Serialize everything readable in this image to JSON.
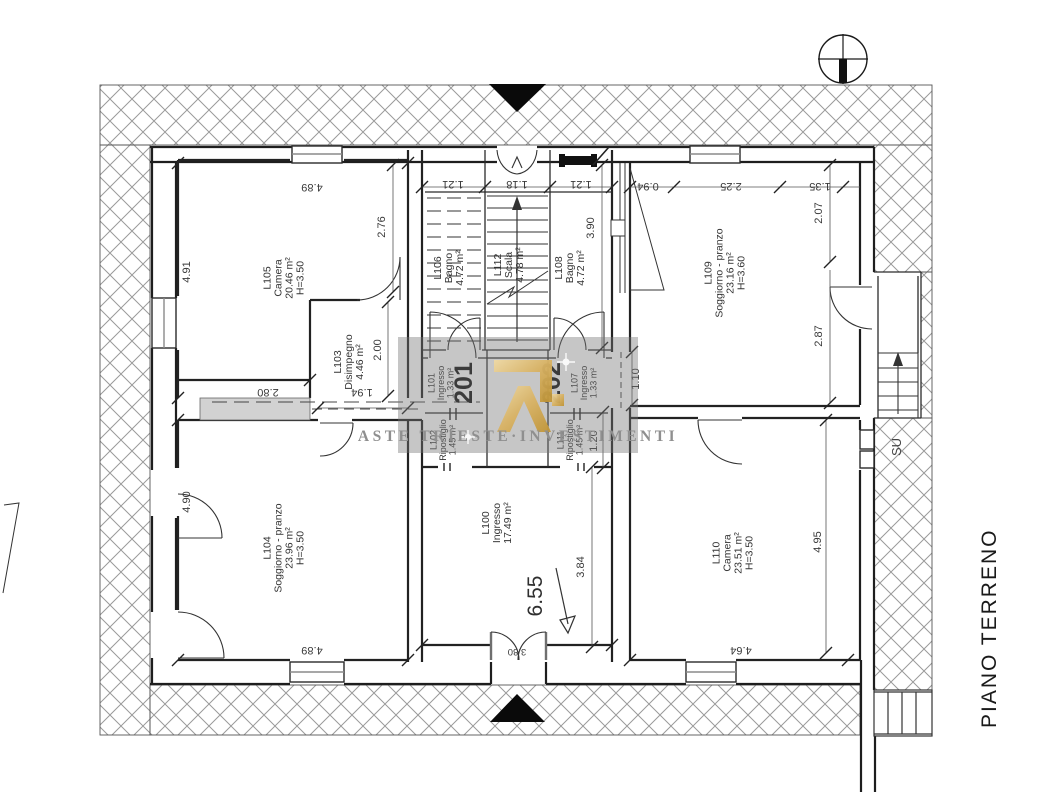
{
  "title": {
    "floor_label": "PIANO TERRENO"
  },
  "watermark": {
    "caption": "ASTE TRIESTE·INVESTIMENTI"
  },
  "units": {
    "unit1": "201",
    "unit2": "202"
  },
  "stairs": {
    "up_label": "SU"
  },
  "rooms": {
    "l105": {
      "id": "L105",
      "name": "Camera",
      "area": "20.46 m²",
      "height": "H=3.50"
    },
    "l103": {
      "id": "L103",
      "name": "Disimpegno",
      "area": "4.46 m²"
    },
    "l104": {
      "id": "L104",
      "name": "Soggiorno - pranzo",
      "area": "23.96 m²",
      "height": "H=3.50"
    },
    "l106": {
      "id": "L106",
      "name": "Bagno",
      "area": "4.72 m²"
    },
    "l112": {
      "id": "L112",
      "name": "Scala",
      "area": "4.78 m²"
    },
    "l108": {
      "id": "L108",
      "name": "Bagno",
      "area": "4.72 m²"
    },
    "l101": {
      "id": "L101",
      "name": "Ingresso",
      "area": "1.33 m²"
    },
    "l107": {
      "id": "L107",
      "name": "Ingresso",
      "area": "1.33 m²"
    },
    "l102": {
      "id": "L102",
      "name": "Ripostiglio",
      "area": "1.45 m²"
    },
    "l111": {
      "id": "L111",
      "name": "Ripostiglio",
      "area": "1.45 m²"
    },
    "l109": {
      "id": "L109",
      "name": "Soggiorno - pranzo",
      "area": "23.16 m²",
      "height": "H=3.60"
    },
    "l100": {
      "id": "L100",
      "name": "Ingresso",
      "area": "17.49 m²"
    },
    "l110": {
      "id": "L110",
      "name": "Camera",
      "area": "23.51 m²",
      "height": "H=3.50"
    }
  },
  "dims": {
    "l105_top": "4.89",
    "l105_left": "4.91",
    "l105_right": "2.76",
    "l105_bottom": "2.80",
    "l103_right": "2.00",
    "l103_bottom": "1.94",
    "stair_left": "1.21",
    "stair_mid": "1.18",
    "stair_right": "1.21",
    "l109_left": "3.90",
    "l109_top_a": "0.94",
    "l109_top_b": "2.25",
    "l109_top_c": "1.35",
    "l109_right": "2.07",
    "landing_door": "2.87",
    "corridor": "1.10",
    "l111_right": "1.20",
    "l104_left": "4.90",
    "l104_bottom": "4.89",
    "l100_width": "6.55",
    "l100_right": "3.84",
    "l100_door": "3.80",
    "l110_right": "4.95",
    "l110_bottom": "4.64"
  },
  "colors": {
    "gold": "#d8b263",
    "hatch": "#9a9a9a",
    "wall": "#1e1e1e"
  }
}
